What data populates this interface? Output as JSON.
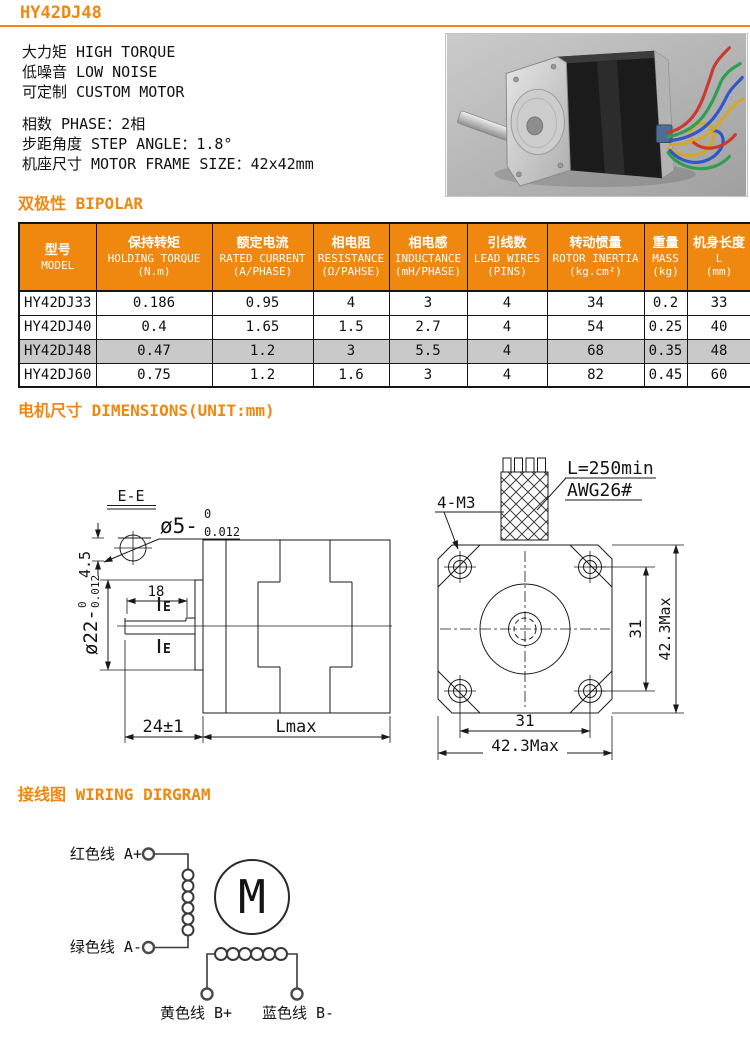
{
  "page": {
    "title": "HY42DJ48"
  },
  "intro": {
    "features": [
      "大力矩 HIGH TORQUE",
      "低噪音 LOW NOISE",
      "可定制 CUSTOM MOTOR"
    ],
    "specs": [
      "相数 PHASE：2相",
      "步距角度 STEP ANGLE：1.8°",
      "机座尺寸 MOTOR FRAME SIZE：42x42mm"
    ]
  },
  "sections": {
    "bipolar": "双极性 BIPOLAR",
    "dimensions": "电机尺寸 DIMENSIONS(UNIT:mm)",
    "wiring": "接线图 WIRING DIRGRAM"
  },
  "table": {
    "columns": [
      {
        "cn": "型号",
        "en": "MODEL",
        "unit": ""
      },
      {
        "cn": "保持转矩",
        "en": "HOLDING TORQUE",
        "unit": "(N.m)"
      },
      {
        "cn": "额定电流",
        "en": "RATED CURRENT",
        "unit": "(A/PHASE)"
      },
      {
        "cn": "相电阻",
        "en": "RESISTANCE",
        "unit": "(Ω/PAHSE)"
      },
      {
        "cn": "相电感",
        "en": "INDUCTANCE",
        "unit": "(mH/PHASE)"
      },
      {
        "cn": "引线数",
        "en": "LEAD WIRES",
        "unit": "(PINS)"
      },
      {
        "cn": "转动惯量",
        "en": "ROTOR INERTIA",
        "unit": "(kg.cm²)"
      },
      {
        "cn": "重量",
        "en": "MASS",
        "unit": "(kg)"
      },
      {
        "cn": "机身长度",
        "en": "L",
        "unit": "(mm)"
      }
    ],
    "rows": [
      [
        "HY42DJ33",
        "0.186",
        "0.95",
        "4",
        "3",
        "4",
        "34",
        "0.2",
        "33"
      ],
      [
        "HY42DJ40",
        "0.4",
        "1.65",
        "1.5",
        "2.7",
        "4",
        "54",
        "0.25",
        "40"
      ],
      [
        "HY42DJ48",
        "0.47",
        "1.2",
        "3",
        "5.5",
        "4",
        "68",
        "0.35",
        "48"
      ],
      [
        "HY42DJ60",
        "0.75",
        "1.2",
        "1.6",
        "3",
        "4",
        "82",
        "0.45",
        "60"
      ]
    ],
    "highlighted_model": "HY42DJ48"
  },
  "drawing": {
    "section_label": "E-E",
    "shaft_flat_depth": "4.5",
    "shaft_dia": {
      "prefix": "ø5-",
      "upper": "0",
      "lower": "0.012"
    },
    "flat_length": "18",
    "section_marker": "E",
    "pilot_dia": {
      "prefix": "ø22-",
      "upper": "0",
      "lower": "0.012"
    },
    "shaft_length": "24±1",
    "body_length": "Lmax",
    "mounting_holes": "4-M3",
    "lead_length": "L=250min",
    "lead_gauge": "AWG26#",
    "hole_spacing_v": "31",
    "frame_size_v": "42.3Max",
    "hole_spacing_h": "31",
    "frame_size_h": "42.3Max"
  },
  "wiring": {
    "phase_a_plus": "红色线 A+",
    "phase_a_minus": "绿色线 A-",
    "phase_b_plus": "黄色线 B+",
    "phase_b_minus": "蓝色线 B-",
    "motor_symbol": "M"
  },
  "colors": {
    "accent": "#f0870f",
    "table_header_bg": "#f0870f",
    "table_header_text": "#ffffff",
    "highlight_row_bg": "#c9c9c9",
    "wire_red": "#c93b30",
    "wire_green": "#2f9e4f",
    "wire_blue": "#3056c9",
    "wire_yellow": "#d4a72c"
  }
}
